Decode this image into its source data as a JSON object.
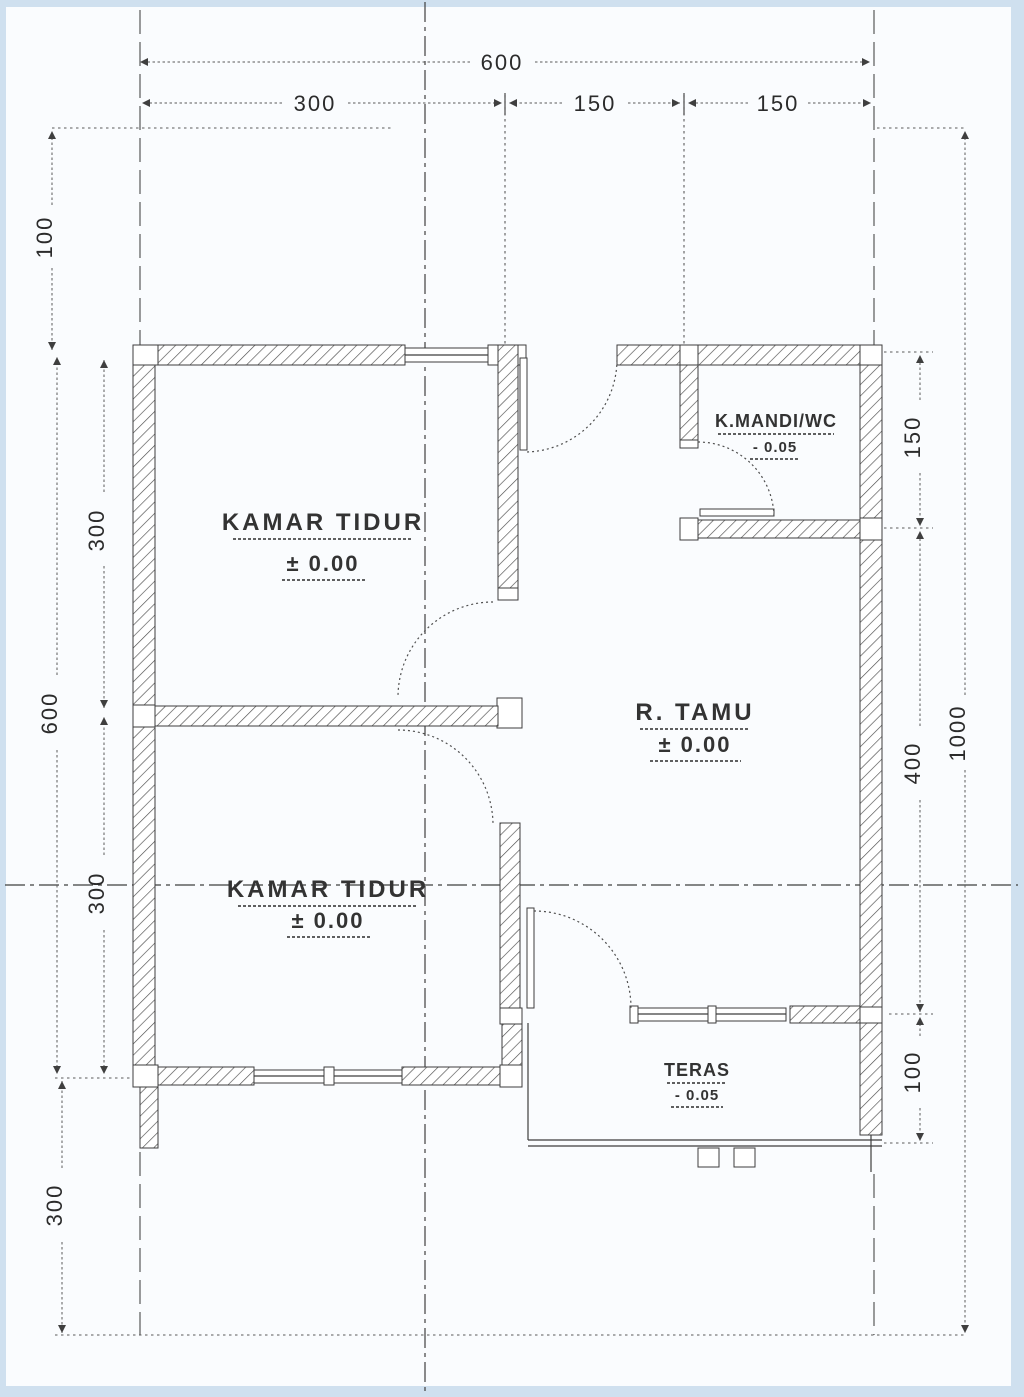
{
  "rooms": {
    "bedroom1": {
      "name": "KAMAR TIDUR",
      "level": "± 0.00"
    },
    "bedroom2": {
      "name": "KAMAR TIDUR",
      "level": "± 0.00"
    },
    "living": {
      "name": "R. TAMU",
      "level": "± 0.00"
    },
    "bath": {
      "name": "K.MANDI/WC",
      "level": "- 0.05"
    },
    "terrace": {
      "name": "TERAS",
      "level": "- 0.05"
    }
  },
  "dimensions": {
    "top": {
      "total": "600",
      "segments": [
        "300",
        "150",
        "150"
      ]
    },
    "left": {
      "margin_top": "100",
      "house_total": "600",
      "rooms": [
        "300",
        "300"
      ],
      "margin_bottom": "300"
    },
    "right": {
      "bath": "150",
      "living": "400",
      "terrace": "100",
      "lot_total": "1000"
    }
  },
  "colors": {
    "scan_border": "#cfe0ef",
    "paper": "#fafcfe",
    "ink": "#3d3d3d"
  }
}
